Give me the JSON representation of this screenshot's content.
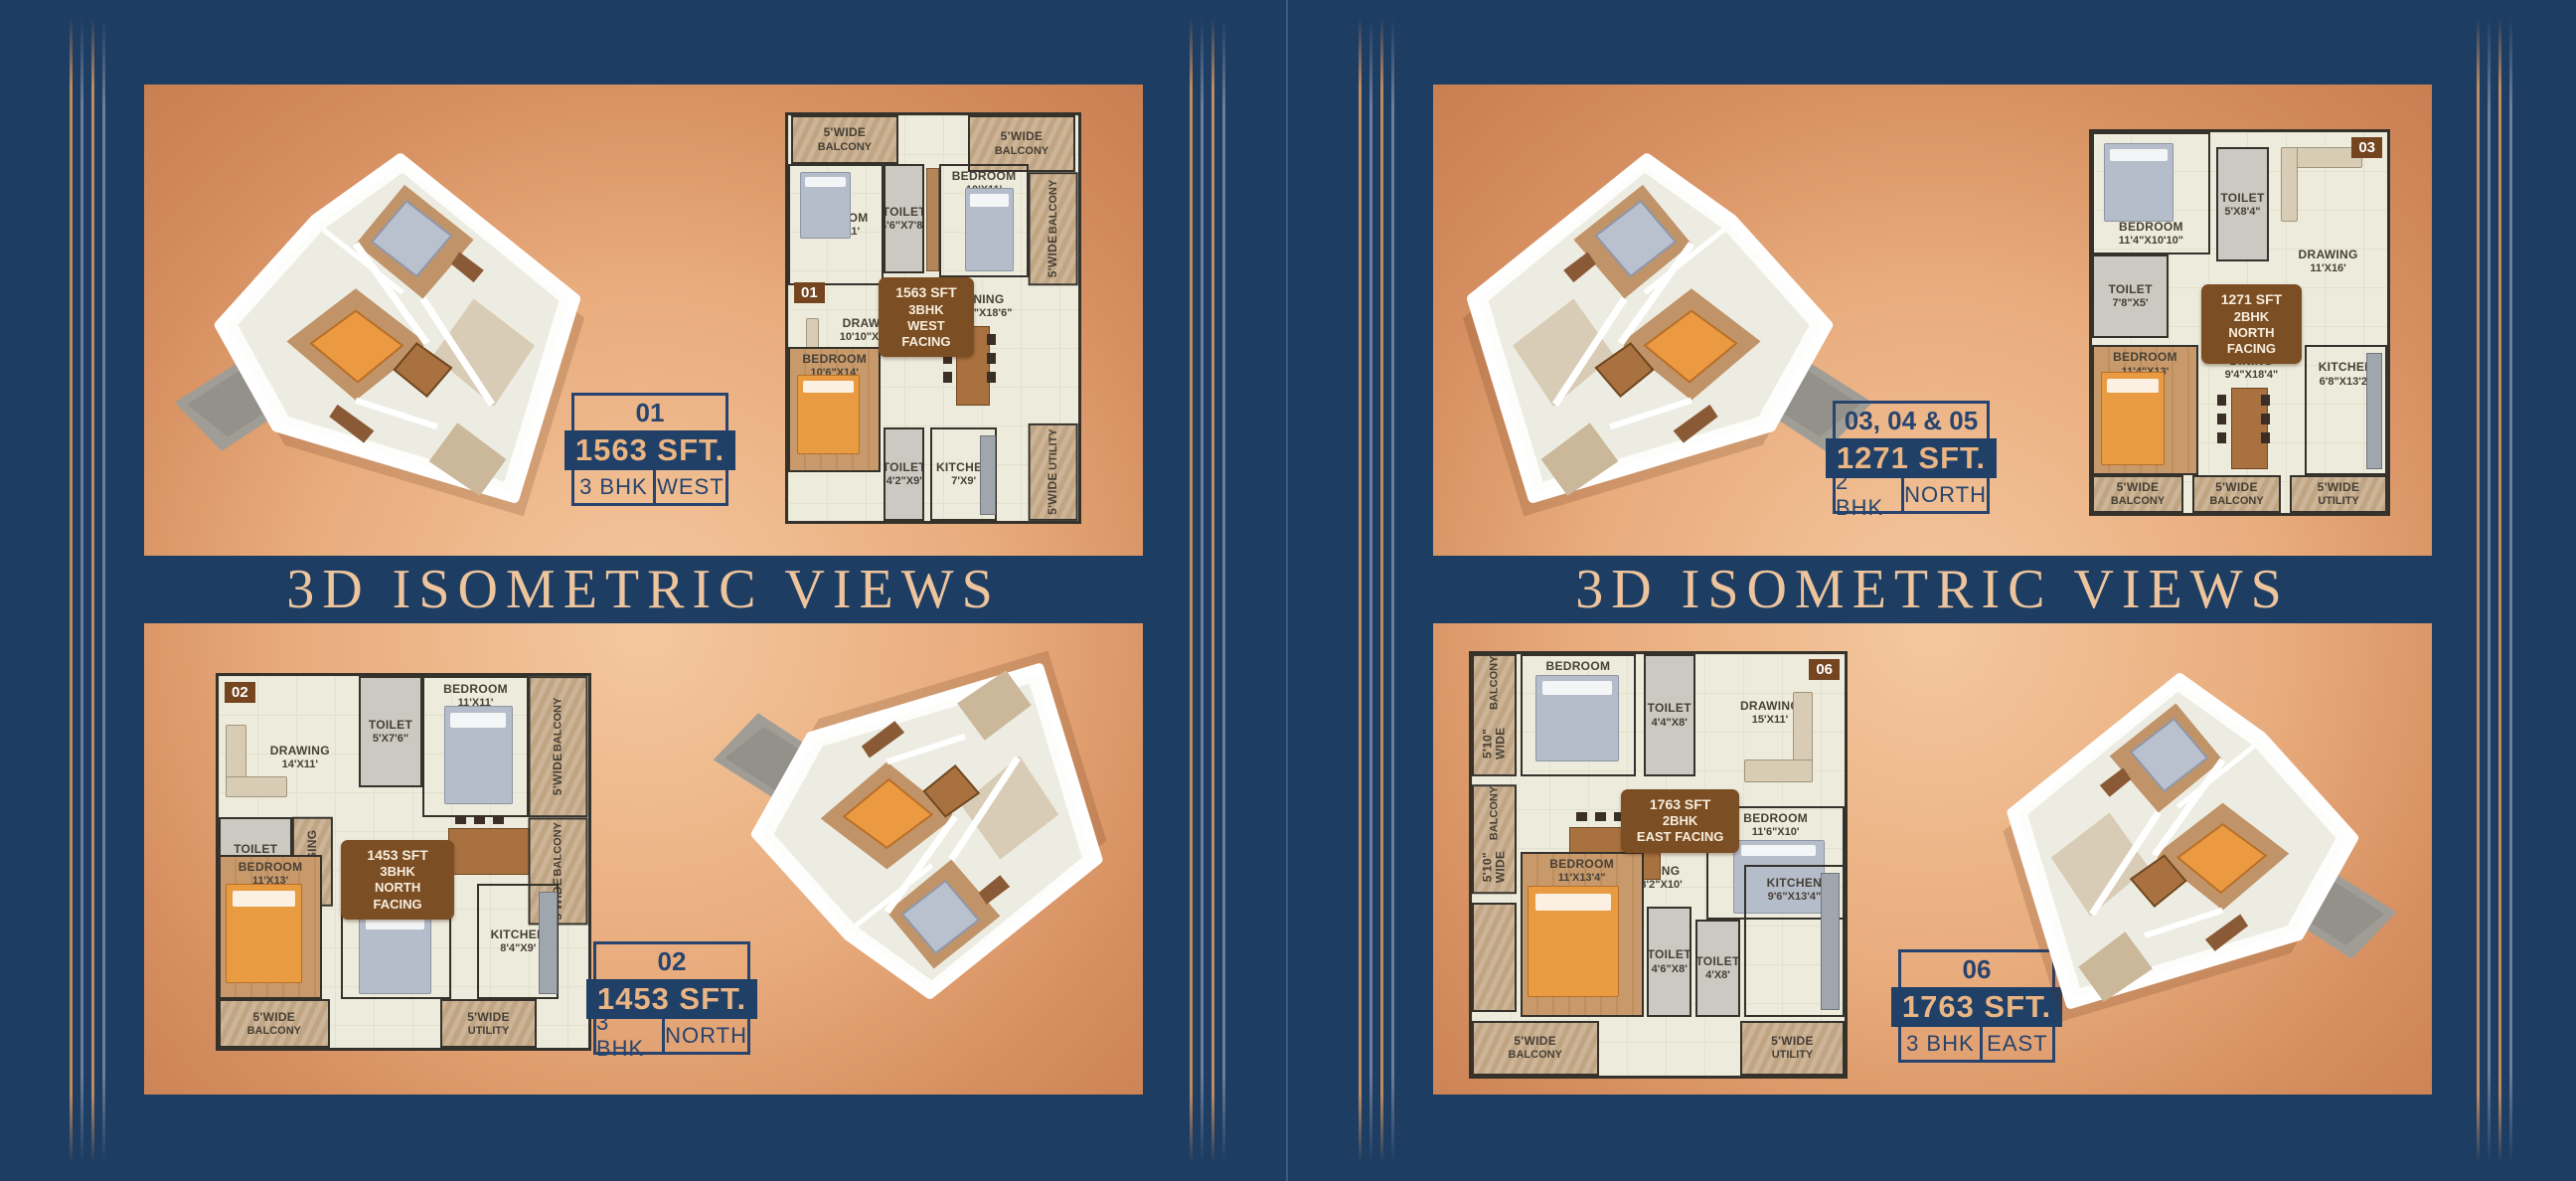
{
  "page": {
    "background": "#1e3d63",
    "panel_copper_center": "#f4c89e",
    "panel_copper_edge": "#c87f52",
    "accent_navy": "#27446e",
    "accent_peach": "#eab483",
    "badge_brown": "#7c4e24"
  },
  "titles": {
    "left": "3D ISOMETRIC VIEWS",
    "right": "3D ISOMETRIC VIEWS"
  },
  "units": {
    "u01": {
      "number": "01",
      "area": "1563 SFT.",
      "bhk": "3 BHK",
      "facing": "WEST"
    },
    "u02": {
      "number": "02",
      "area": "1453 SFT.",
      "bhk": "3 BHK",
      "facing": "NORTH"
    },
    "u030405": {
      "number": "03, 04 & 05",
      "area": "1271 SFT.",
      "bhk": "2 BHK",
      "facing": "NORTH"
    },
    "u06": {
      "number": "06",
      "area": "1763 SFT.",
      "bhk": "3 BHK",
      "facing": "EAST"
    }
  },
  "plans": {
    "p01": {
      "number": "01",
      "badge": {
        "area": "1563 SFT",
        "bhk": "3BHK",
        "facing": "WEST FACING"
      },
      "rooms": {
        "balc_tl": {
          "l1": "5'WIDE",
          "l2": "BALCONY"
        },
        "balc_tr": {
          "l1": "5'WIDE",
          "l2": "BALCONY"
        },
        "bed1": {
          "l1": "BEDROOM",
          "l2": "10'2\"X11'"
        },
        "toilet1": {
          "l1": "TOILET",
          "l2": "4'6\"X7'8\""
        },
        "bed2": {
          "l1": "BEDROOM",
          "l2": "10'X11'"
        },
        "balc_r": {
          "l1": "5'WIDE",
          "l2": "BALCONY"
        },
        "dining": {
          "l1": "DINING",
          "l2": "12'6\"X18'6\""
        },
        "drawing": {
          "l1": "DRAWING",
          "l2": "10'10\"X13'6\""
        },
        "bed3": {
          "l1": "BEDROOM",
          "l2": "10'6\"X14'"
        },
        "toilet2": {
          "l1": "TOILET",
          "l2": "4'2\"X9'"
        },
        "kitchen": {
          "l1": "KITCHEN",
          "l2": "7'X9'"
        },
        "utility": {
          "l1": "5'WIDE",
          "l2": "UTILITY"
        }
      }
    },
    "p02": {
      "number": "02",
      "badge": {
        "area": "1453 SFT",
        "bhk": "3BHK",
        "facing": "NORTH FACING"
      },
      "rooms": {
        "drawing": {
          "l1": "DRAWING",
          "l2": "14'X11'"
        },
        "toilet1": {
          "l1": "TOILET",
          "l2": "5'X7'6\""
        },
        "bed1": {
          "l1": "BEDROOM",
          "l2": "11'X11'"
        },
        "balc_r1": {
          "l1": "5'WIDE",
          "l2": "BALCONY"
        },
        "toilet2": {
          "l1": "TOILET",
          "l2": "7'X5'"
        },
        "dressing": {
          "l1": "DRESSING",
          "l2": ""
        },
        "dining": {
          "l1": "DINING",
          "l2": "18'8\"X9'"
        },
        "balc_r2": {
          "l1": "5'WIDE",
          "l2": "BALCONY"
        },
        "bed2": {
          "l1": "BEDROOM",
          "l2": "11'X13'"
        },
        "bed3": {
          "l1": "BEDROOM",
          "l2": "10'X9'"
        },
        "kitchen": {
          "l1": "KITCHEN",
          "l2": "8'4\"X9'"
        },
        "balc_b": {
          "l1": "5'WIDE",
          "l2": "BALCONY"
        },
        "utility": {
          "l1": "5'WIDE",
          "l2": "UTILITY"
        }
      }
    },
    "p03": {
      "number": "03",
      "badge": {
        "area": "1271 SFT",
        "bhk": "2BHK",
        "facing": "NORTH FACING"
      },
      "rooms": {
        "bed1": {
          "l1": "BEDROOM",
          "l2": "11'4\"X10'10\""
        },
        "toilet1": {
          "l1": "TOILET",
          "l2": "5'X8'4\""
        },
        "drawing": {
          "l1": "DRAWING",
          "l2": "11'X16'"
        },
        "toilet2": {
          "l1": "TOILET",
          "l2": "7'8\"X5'"
        },
        "bed2": {
          "l1": "BEDROOM",
          "l2": "11'4\"X13'"
        },
        "dining": {
          "l1": "DINING",
          "l2": "9'4\"X18'4\""
        },
        "kitchen": {
          "l1": "KITCHEN",
          "l2": "6'8\"X13'2\""
        },
        "balc_b1": {
          "l1": "5'WIDE",
          "l2": "BALCONY"
        },
        "balc_b2": {
          "l1": "5'WIDE",
          "l2": "BALCONY"
        },
        "utility": {
          "l1": "5'WIDE",
          "l2": "UTILITY"
        }
      }
    },
    "p06": {
      "number": "06",
      "badge": {
        "area": "1763 SFT",
        "bhk": "2BHK",
        "facing": "EAST FACING"
      },
      "rooms": {
        "balc_l1": {
          "l1": "5'10\" WIDE",
          "l2": "BALCONY"
        },
        "balc_l2": {
          "l1": "5'10\" WIDE",
          "l2": "BALCONY"
        },
        "bed1": {
          "l1": "BEDROOM",
          "l2": "10'X11'"
        },
        "toilet1": {
          "l1": "TOILET",
          "l2": "4'4\"X8'"
        },
        "drawing": {
          "l1": "DRAWING",
          "l2": "15'X11'"
        },
        "bed2": {
          "l1": "BEDROOM",
          "l2": "11'6\"X10'"
        },
        "dining": {
          "l1": "DINING",
          "l2": "18'2\"X10'"
        },
        "bed3": {
          "l1": "BEDROOM",
          "l2": "11'X13'4\""
        },
        "kitchen": {
          "l1": "KITCHEN",
          "l2": "9'6\"X13'4\""
        },
        "toilet2": {
          "l1": "TOILET",
          "l2": "4'6\"X8'"
        },
        "toilet3": {
          "l1": "TOILET",
          "l2": "4'X8'"
        },
        "balc_b": {
          "l1": "5'WIDE",
          "l2": "BALCONY"
        },
        "utility": {
          "l1": "5'WIDE",
          "l2": "UTILITY"
        }
      }
    }
  }
}
